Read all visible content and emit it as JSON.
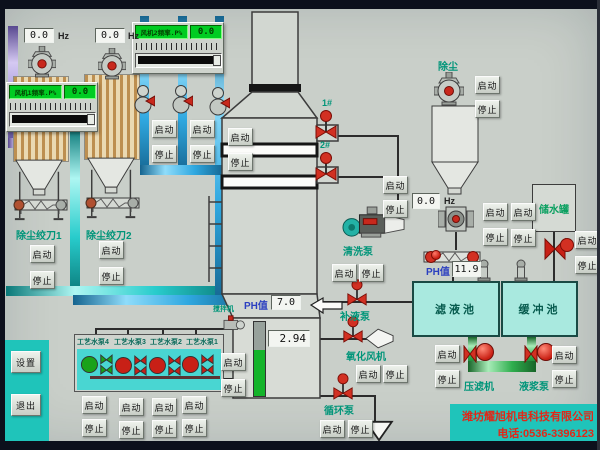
{
  "colors": {
    "teal_block": "#1fc4ba",
    "tank_fill": "#a9e9df",
    "green_display": "#00cc22",
    "label_teal": "#009579",
    "ph_label_blue": "#2b3fc0",
    "company_red": "#e02818",
    "pipe_blue": "#2fa8e0",
    "pipe_cyan": "#28cccc",
    "pipe_green": "#2fae4e",
    "pipe_purple": "#9a8fd8",
    "valve_red": "#c82016",
    "running_green": "#1aa21a"
  },
  "btn": {
    "start": "启动",
    "stop": "停止"
  },
  "nav": {
    "settings": "设置",
    "exit": "退出"
  },
  "fan_panels": [
    {
      "label": "风机1频率.P%",
      "value": "0.0"
    },
    {
      "label": "风机2频率.P%",
      "value": "0.0"
    }
  ],
  "freq_displays": [
    {
      "value": "0.0",
      "unit": "Hz"
    },
    {
      "value": "0.0",
      "unit": "Hz"
    },
    {
      "value": "0.0",
      "unit": "Hz"
    }
  ],
  "dust_units": [
    {
      "label": "除尘绞刀1"
    },
    {
      "label": "除尘绞刀2"
    }
  ],
  "tower": {
    "ph_label": "PH值",
    "ph_value": "7.0",
    "level_value": "2.94",
    "mixer_label": "搅拌机",
    "inlet_labels": [
      "1#",
      "2#"
    ]
  },
  "devices": {
    "cleaning_pump": "清洗泵",
    "refill_pump": "补液泵",
    "oxidation_fan": "氧化风机",
    "circulation_pump": "循环泵",
    "dust_collector": "除尘",
    "water_tank": "储水罐",
    "filtrate_tank": "滤液池",
    "buffer_tank": "缓冲池",
    "filter_press": "压滤机",
    "slurry_pump": "液浆泵"
  },
  "right_ph": {
    "label": "PH值",
    "value": "11.9"
  },
  "process_pumps": [
    {
      "label": "工艺水泵4",
      "state": "running"
    },
    {
      "label": "工艺水泵3",
      "state": "stopped"
    },
    {
      "label": "工艺水泵2",
      "state": "stopped"
    },
    {
      "label": "工艺水泵1",
      "state": "stopped"
    }
  ],
  "footer": {
    "company": "潍坊耀旭机电科技有限公司",
    "phone": "电话:0536-3396123"
  }
}
